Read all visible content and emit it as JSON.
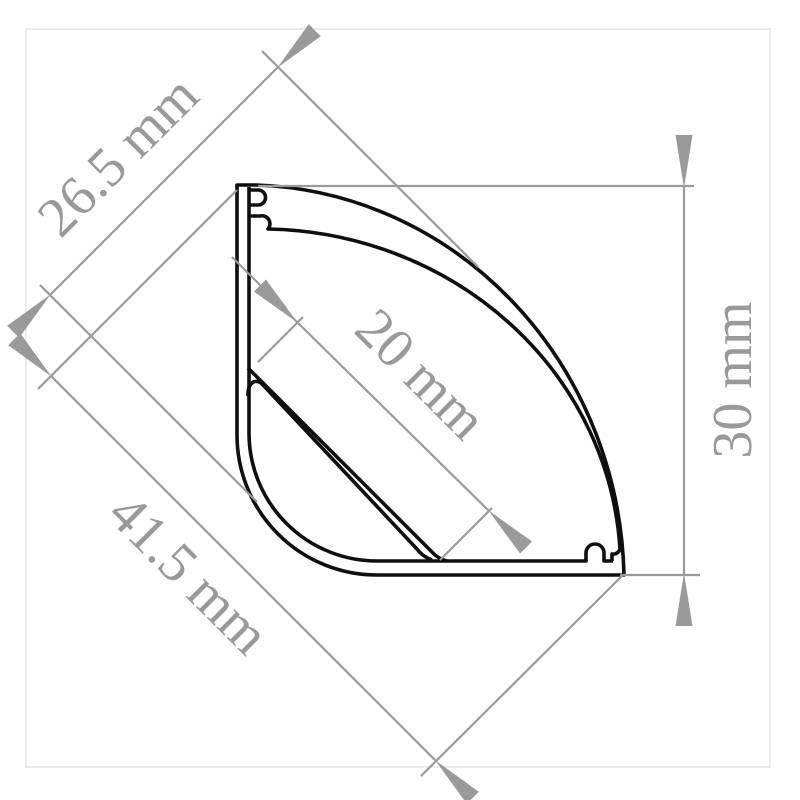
{
  "figure": {
    "type": "technical-drawing",
    "subject": "corner-led-aluminium-profile-cross-section",
    "unit": "mm",
    "colors": {
      "outline": "#0f0f0f",
      "dimension_lines": "#9a9a9a",
      "labels": "#999999",
      "frame_border": "#ebebeb",
      "background": "#ffffff"
    },
    "dimensions": {
      "top_diagonal": {
        "label": "26.5 mm",
        "value": 26.5,
        "unit": "mm",
        "orientation": "diagonal-45"
      },
      "height_right": {
        "label": "30 mm",
        "value": 30,
        "unit": "mm",
        "orientation": "vertical"
      },
      "led_surface": {
        "label": "20 mm",
        "value": 20,
        "unit": "mm",
        "orientation": "diagonal-45"
      },
      "bottom_diagonal": {
        "label": "41.5 mm",
        "value": 41.5,
        "unit": "mm",
        "orientation": "diagonal-45"
      }
    }
  }
}
